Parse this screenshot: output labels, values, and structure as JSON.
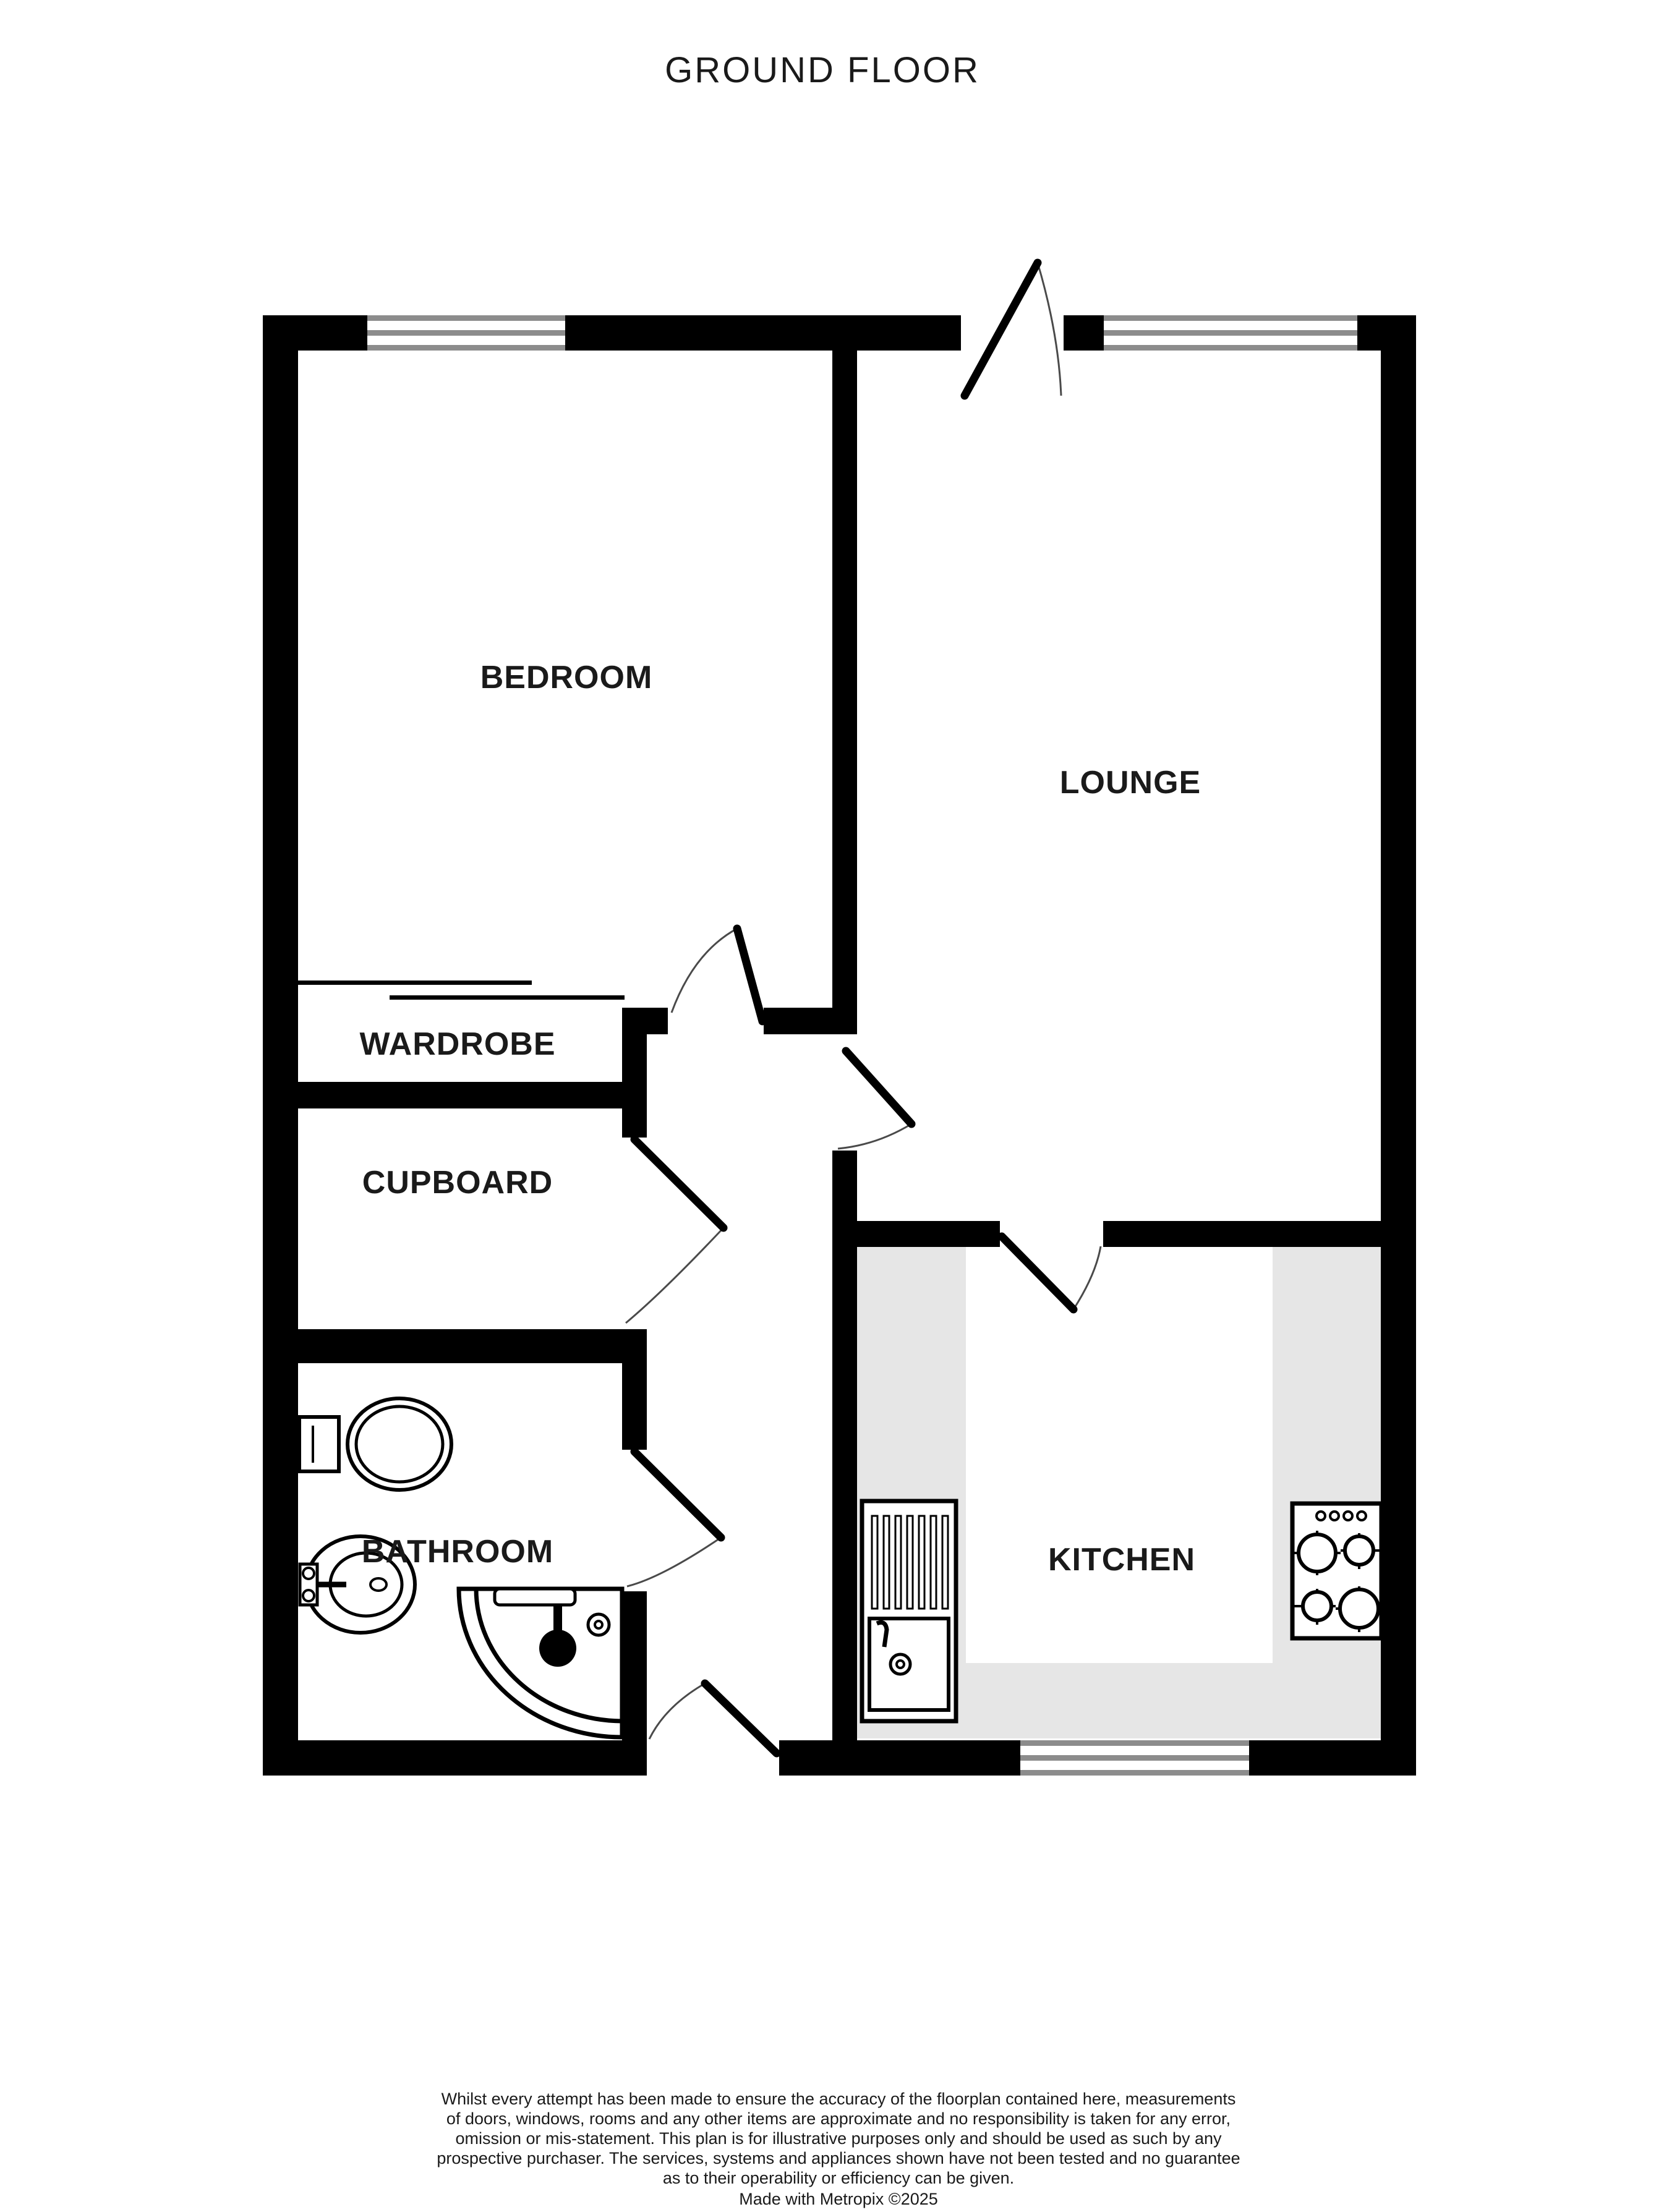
{
  "title": "GROUND FLOOR",
  "rooms": {
    "bedroom": {
      "label": "BEDROOM"
    },
    "lounge": {
      "label": "LOUNGE"
    },
    "wardrobe": {
      "label": "WARDROBE"
    },
    "cupboard": {
      "label": "CUPBOARD"
    },
    "bathroom": {
      "label": "BATHROOM"
    },
    "kitchen": {
      "label": "KITCHEN"
    }
  },
  "features": {
    "windows": [
      "bedroom-window",
      "lounge-window",
      "kitchen-window"
    ],
    "doors": [
      "entrance-door",
      "bedroom-door",
      "lounge-door",
      "cupboard-door",
      "bathroom-door",
      "front-hall-door",
      "kitchen-door"
    ],
    "icons": [
      "toilet-icon",
      "washbasin-icon",
      "corner-shower-icon",
      "kitchen-sink-icon",
      "hob-icon"
    ]
  },
  "colors": {
    "wall": "#000000",
    "window_frame": "#8c8c8c",
    "counter": "#e6e6e6",
    "door_arc": "#4a4a4a",
    "text": "#1a1a1a",
    "background": "#ffffff"
  },
  "disclaimer": {
    "lines": [
      "Whilst every attempt has been made to ensure the accuracy of the floorplan contained here, measurements",
      "of doors, windows, rooms and any other items are approximate and no responsibility is taken for any error,",
      "omission or mis-statement. This plan is for illustrative purposes only and should be used as such by any",
      "prospective purchaser. The services, systems and appliances shown have not been tested and no guarantee",
      "as to their operability or efficiency can be given."
    ],
    "credit": "Made with Metropix ©2025"
  }
}
